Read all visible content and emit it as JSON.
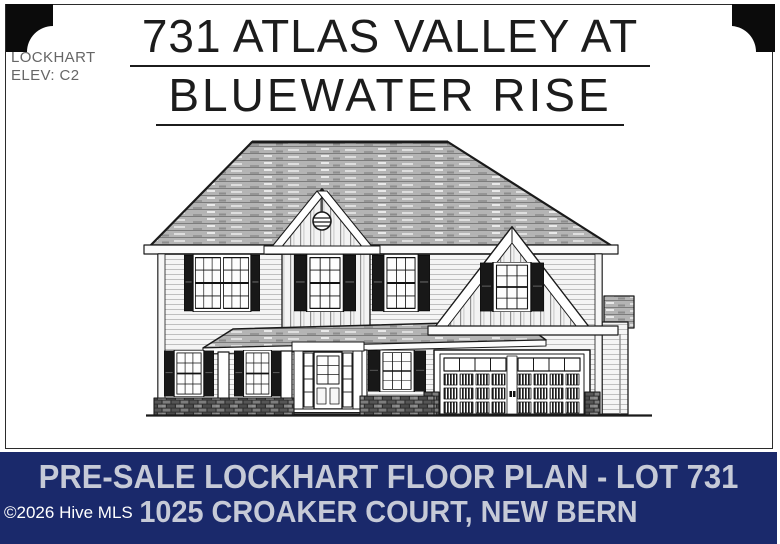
{
  "sheet": {
    "plan_label": {
      "name": "LOCKHART",
      "elevation": "ELEV: C2"
    },
    "title": {
      "line1": "731 ATLAS VALLEY AT",
      "line2": "BLUEWATER RISE"
    },
    "drawing_alt": "Front elevation architectural drawing of a two-story home with shingled hip roof, center board-and-batten gable with round vent, covered front porch with columns, front door with sidelights, shuttered windows, right-side gable over a two-car garage door with brick piers, and brick foundation skirt"
  },
  "banner": {
    "line1": "PRE-SALE LOCKHART FLOOR PLAN - LOT 731",
    "line2": "1025 CROAKER COURT, NEW BERN",
    "watermark": "©2026 Hive MLS",
    "colors": {
      "background": "#1a296b",
      "text": "#c6cad7",
      "watermark_text": "#ffffff"
    }
  }
}
